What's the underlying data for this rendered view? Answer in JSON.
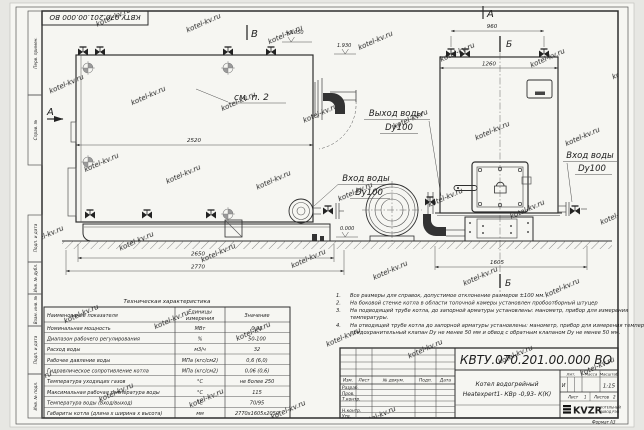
{
  "watermark": "kotel-kv.ru",
  "doc_number": "КВТУ.070.201.00.000  ВО",
  "margin": {
    "perv": "Перв. примен.",
    "sprav": "Справ. №",
    "podp1": "Подп. и дата",
    "inv_dubl": "Инв. № дубл.",
    "vzam": "Взам. инв. №",
    "podp2": "Подп. и дата",
    "inv_podl": "Инв. № подл."
  },
  "views": {
    "side_label": "В",
    "side_section": "А",
    "see_note": "см. п. 2",
    "front_label": "А",
    "section_top": "Б",
    "section_bottom": "Б",
    "dim_2520": "2520",
    "dim_2650": "2650",
    "dim_2770": "2770",
    "dim_960": "960",
    "dim_1260": "1260",
    "dim_1605": "1605",
    "elev_top": "+2.050",
    "elev_out": "1.930",
    "elev_zero": "0.000",
    "outlet_l1": "Выход воды",
    "outlet_l2": "Dy100",
    "inlet_mid_l1": "Вход воды",
    "inlet_mid_l2": "Dy100",
    "inlet_right_l1": "Вход воды",
    "inlet_right_l2": "Dy100"
  },
  "notes": {
    "n1_num": "1.",
    "n1": "Все размеры для справок, допустимое отклонение размеров ±100 мм.",
    "n2_num": "2.",
    "n2": "На боковой стенке котла в области топочной камеры установлен пробоотборный штуцер",
    "n3_num": "3.",
    "n3a": "На  подводящей трубе котла, до запорной арматуры установлены: манометр, прибор для измерения",
    "n3b": "температуры.",
    "n4_num": "4.",
    "n4a": "На отводящей трубе котла до запорной арматуры установлены: манометр, прибор для измерения температуры,",
    "n4b": "предохранительный клапан Dу не менее 50 мм и обвод с обратным клапаном Dу не менее 50 мм."
  },
  "spec": {
    "title": "Техническая характеристика",
    "h_name": "Наименование показателя",
    "h_units1": "Единицы",
    "h_units2": "измерения",
    "h_value": "Значение",
    "rows": [
      [
        "Номинальная мощность",
        "МВт",
        "0,93"
      ],
      [
        "Диапазон рабочего регулирования",
        "%",
        "50-100"
      ],
      [
        "Расход воды",
        "м3/ч",
        "32"
      ],
      [
        "Рабочее давление воды",
        "МПа (кгс/см2)",
        "0,6 (6,0)"
      ],
      [
        "Гидравлическое сопротивление котла",
        "МПа (кгс/см2)",
        "0,06 (0,6)"
      ],
      [
        "Температура уходящих газов",
        "°С",
        "не более 250"
      ],
      [
        "Максимальная рабочая температура воды",
        "°С",
        "115"
      ],
      [
        "Температура воды (вход/выход)",
        "°С",
        "70/95"
      ],
      [
        "Габариты котла (длина х ширина х высота)",
        "мм",
        "2770х1605х2050"
      ]
    ]
  },
  "tb": {
    "name1": "Котел водогрейный",
    "name2": "Heatexpert1- КВр -0,93- К(К)",
    "izm": "Изм.",
    "list_col": "Лист",
    "docum": "№ докум.",
    "podp": "Подп.",
    "data": "Дата",
    "razrab": "Разраб.",
    "prov": "Пров.",
    "tkontr": "Т.контр.",
    "nkontr": "Н.контр.",
    "utv": "Утв.",
    "lit": "Лит.",
    "lit_val": "И",
    "massa": "Масса",
    "masshtab": "Масштаб",
    "masshtab_val": "1:15",
    "list": "Лист",
    "list_val": "1",
    "listov": "Листов",
    "listov_val": "2",
    "logo": "KVZR",
    "comp1": "КОТЕЛЬНЫЙ",
    "comp2": "ЗАВОД РЭП",
    "format_lbl": "Формат",
    "format_val": "А3"
  }
}
